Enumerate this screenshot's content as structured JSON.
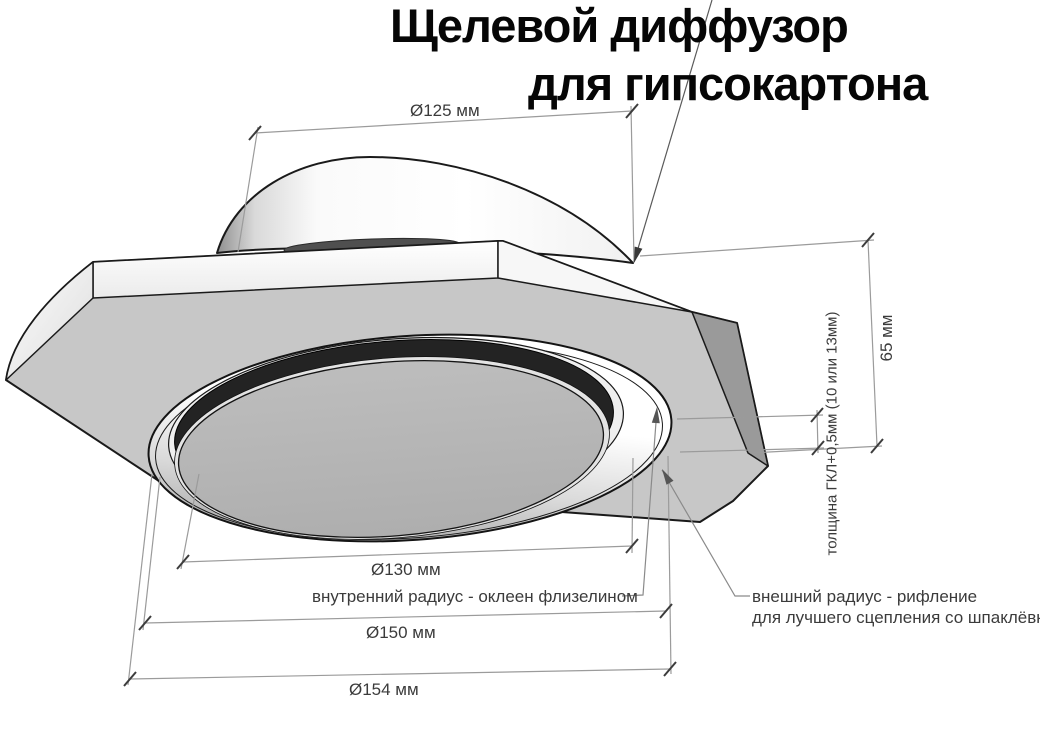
{
  "title": {
    "line1": "Щелевой диффузор",
    "line2": "для гипсокартона"
  },
  "dimensions": {
    "duct_diameter": "Ø125 мм",
    "inner_diameter": "Ø130 мм",
    "flange_diameter": "Ø150 мм",
    "outer_diameter": "Ø154 мм",
    "height": "65 мм",
    "board_thickness": "толщина ГКЛ+0,5мм (10 или 13мм)"
  },
  "annotations": {
    "inner_radius": "внутренний радиус - оклеен флизелином",
    "outer_radius_line1": "внешний радиус - рифление",
    "outer_radius_line2": "для лучшего сцепления со шпаклёвкой"
  },
  "colors": {
    "background": "#ffffff",
    "panel_face": "#c7c7c7",
    "panel_bevel": "#9a9a9a",
    "slot_ring": "#232323",
    "center_disc": "#b3b3b3",
    "dimension_line": "#9b9b9b",
    "tick": "#3c3c3c",
    "dimension_text": "#3b3b3b",
    "title_text": "#060606"
  }
}
